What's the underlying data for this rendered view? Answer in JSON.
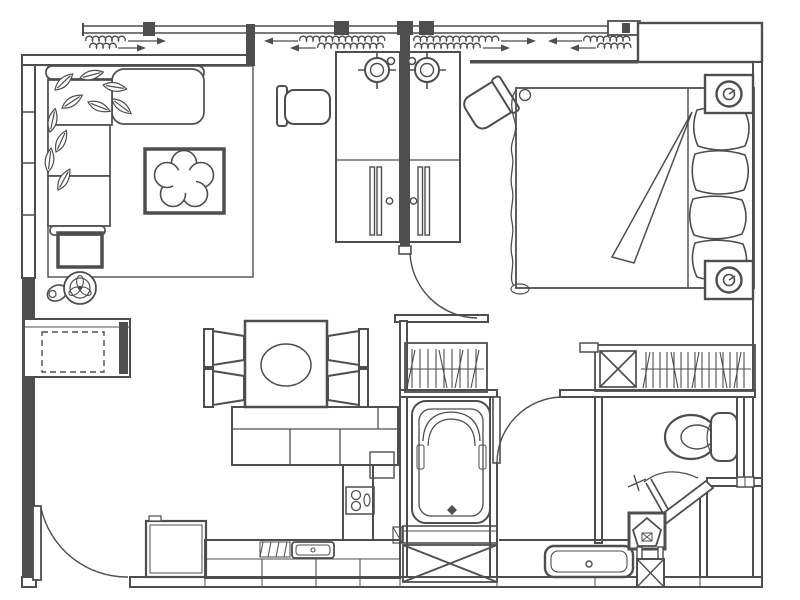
{
  "meta": {
    "type": "apartment-floor-plan",
    "drawing_style": "monochrome architectural line drawing",
    "visible_text": ""
  },
  "colors": {
    "line": "#4e4e4e",
    "background": "#ffffff"
  },
  "structure": {
    "walls": [
      "left-window-wall",
      "top-balcony-window-band",
      "top-right-wall-block",
      "right-wall",
      "bottom-wall",
      "desk-partition-wall",
      "bathroom-walls",
      "wc-walls",
      "chamfered-corner-wall"
    ],
    "windows": [
      "left-window-with-mullions",
      "top-window-band-with-mullions",
      "bedroom-top-window"
    ],
    "doors": [
      "entry-door-bottom-left",
      "hall-door-at-partition",
      "bathroom-door",
      "wc-door"
    ],
    "curtains": [
      {
        "name": "living-curtain",
        "arrow_direction": "right"
      },
      {
        "name": "desk-left-curtain",
        "arrow_direction": "left"
      },
      {
        "name": "desk-right-curtain",
        "arrow_direction": "right"
      },
      {
        "name": "bedroom-curtain",
        "arrow_direction": "left"
      }
    ]
  },
  "rooms": {
    "living_room": {
      "furniture": [
        "area-rug",
        "l-shaped-sofa",
        "plant-leaves",
        "coffee-table-with-flower-centerpiece",
        "side-table",
        "floor-fan",
        "sideboard-with-dashed-front"
      ]
    },
    "work_area": {
      "furniture": [
        "desk-left",
        "desk-right",
        "desk-lamp-left",
        "desk-lamp-right",
        "monitor-left",
        "monitor-right",
        "desk-chair-left",
        "desk-chair-right-rotated"
      ]
    },
    "bedroom": {
      "furniture": [
        "double-bed",
        "blanket-fold",
        "four-pillows",
        "nightstand-top-with-speaker",
        "nightstand-bottom-with-speaker"
      ]
    },
    "dining_area": {
      "furniture": [
        "square-dining-table",
        "oval-centerpiece",
        "dining-chair-x4",
        "buffet-counter"
      ]
    },
    "kitchen": {
      "furniture": [
        "refrigerator",
        "lower-counter",
        "kitchen-sink",
        "drainer-hatch",
        "tall-counter-column",
        "two-burner-hob"
      ]
    },
    "bathroom": {
      "furniture": [
        "bathtub-with-drain",
        "step-band",
        "duct-x-box",
        "hanger-closet-1"
      ]
    },
    "wc_area": {
      "furniture": [
        "toilet",
        "vanity-sink",
        "hanger-closet-2-with-shelf-x-box",
        "pentagon-column",
        "small-x-shaft",
        "wall-vent"
      ]
    }
  }
}
